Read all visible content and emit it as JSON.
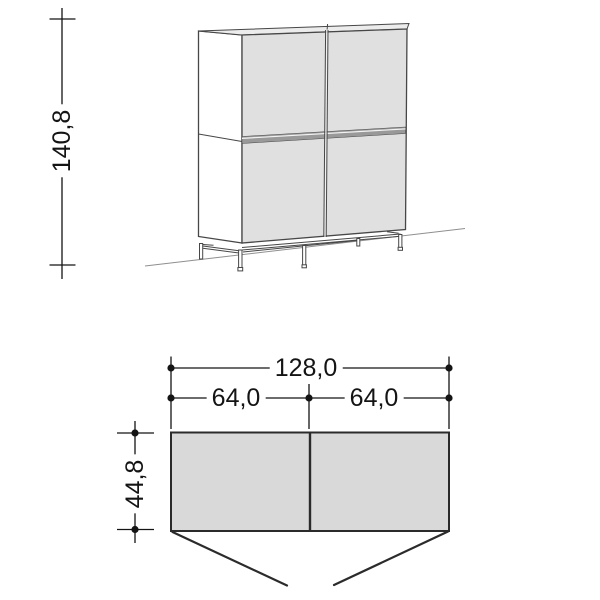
{
  "dimensions": {
    "height": "140,8",
    "total_width": "128,0",
    "left_width": "64,0",
    "right_width": "64,0",
    "depth": "44,8"
  },
  "colors": {
    "background": "#ffffff",
    "door_fill": "#e0e0e0",
    "top_fill": "#ececec",
    "side_fill": "#ffffff",
    "band_fill": "#999999",
    "plan_fill": "#d9d9d9",
    "outline": "#474747",
    "plan_outline": "#2b2b2b",
    "dim_color": "#141414",
    "ground_color": "#8f8f8f"
  }
}
